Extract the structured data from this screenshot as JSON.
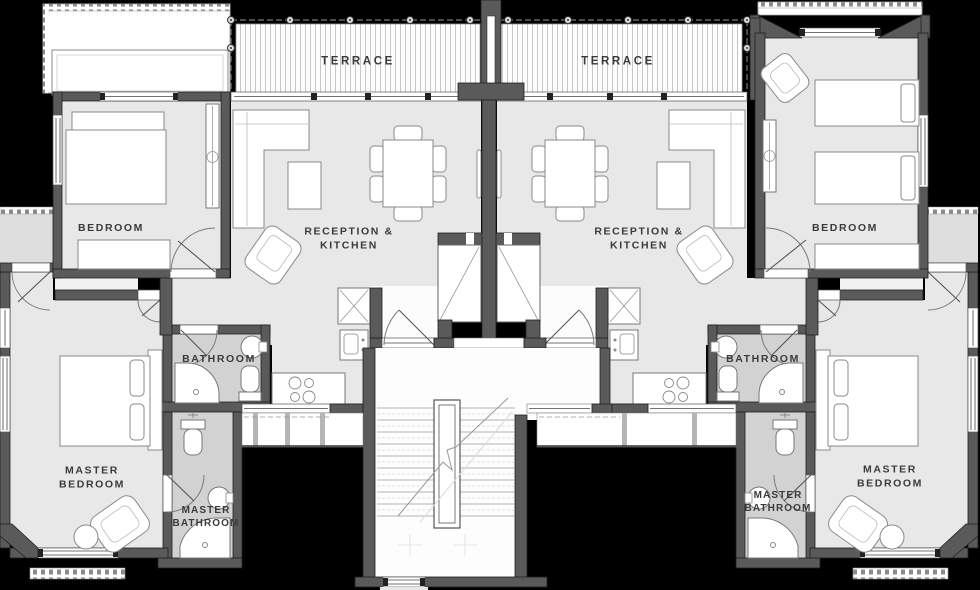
{
  "document": {
    "type": "architectural floor plan",
    "view": "top-down",
    "description": "Two mirrored apartment units sharing a central staircase, terraces at top, black background"
  },
  "units": [
    {
      "name": "left unit",
      "rooms": [
        "TERRACE",
        "BEDROOM",
        "RECEPTION & KITCHEN",
        "BATHROOM",
        "MASTER BEDROOM",
        "MASTER BATHROOM"
      ]
    },
    {
      "name": "right unit",
      "rooms": [
        "TERRACE",
        "BEDROOM",
        "RECEPTION & KITCHEN",
        "BATHROOM",
        "MASTER BEDROOM",
        "MASTER BATHROOM"
      ]
    }
  ],
  "labels": {
    "terrace_left": "TERRACE",
    "terrace_right": "TERRACE",
    "bedroom_left": "BEDROOM",
    "bedroom_right": "BEDROOM",
    "reception_kitchen_left": "RECEPTION &\nKITCHEN",
    "reception_kitchen_right": "RECEPTION &\nKITCHEN",
    "bathroom_left": "BATHROOM",
    "bathroom_right": "BATHROOM",
    "master_bedroom_left": "MASTER\nBEDROOM",
    "master_bedroom_right": "MASTER\nBEDROOM",
    "master_bathroom_left": "MASTER\nBATHROOM",
    "master_bathroom_right": "MASTER\nBATHROOM"
  },
  "colors": {
    "background": "#000000",
    "floor": "#e8e8e8",
    "floor_bathroom": "#d2d2d2",
    "floor_balcony": "#dedede",
    "wall": "#5a5a5a",
    "wall_outline": "#1e1e1e",
    "terrace_stripe": "#c8c8c8",
    "furniture_fill": "#ffffff",
    "furniture_outline": "#8a8a8a",
    "label_text": "#3a3a3a"
  }
}
